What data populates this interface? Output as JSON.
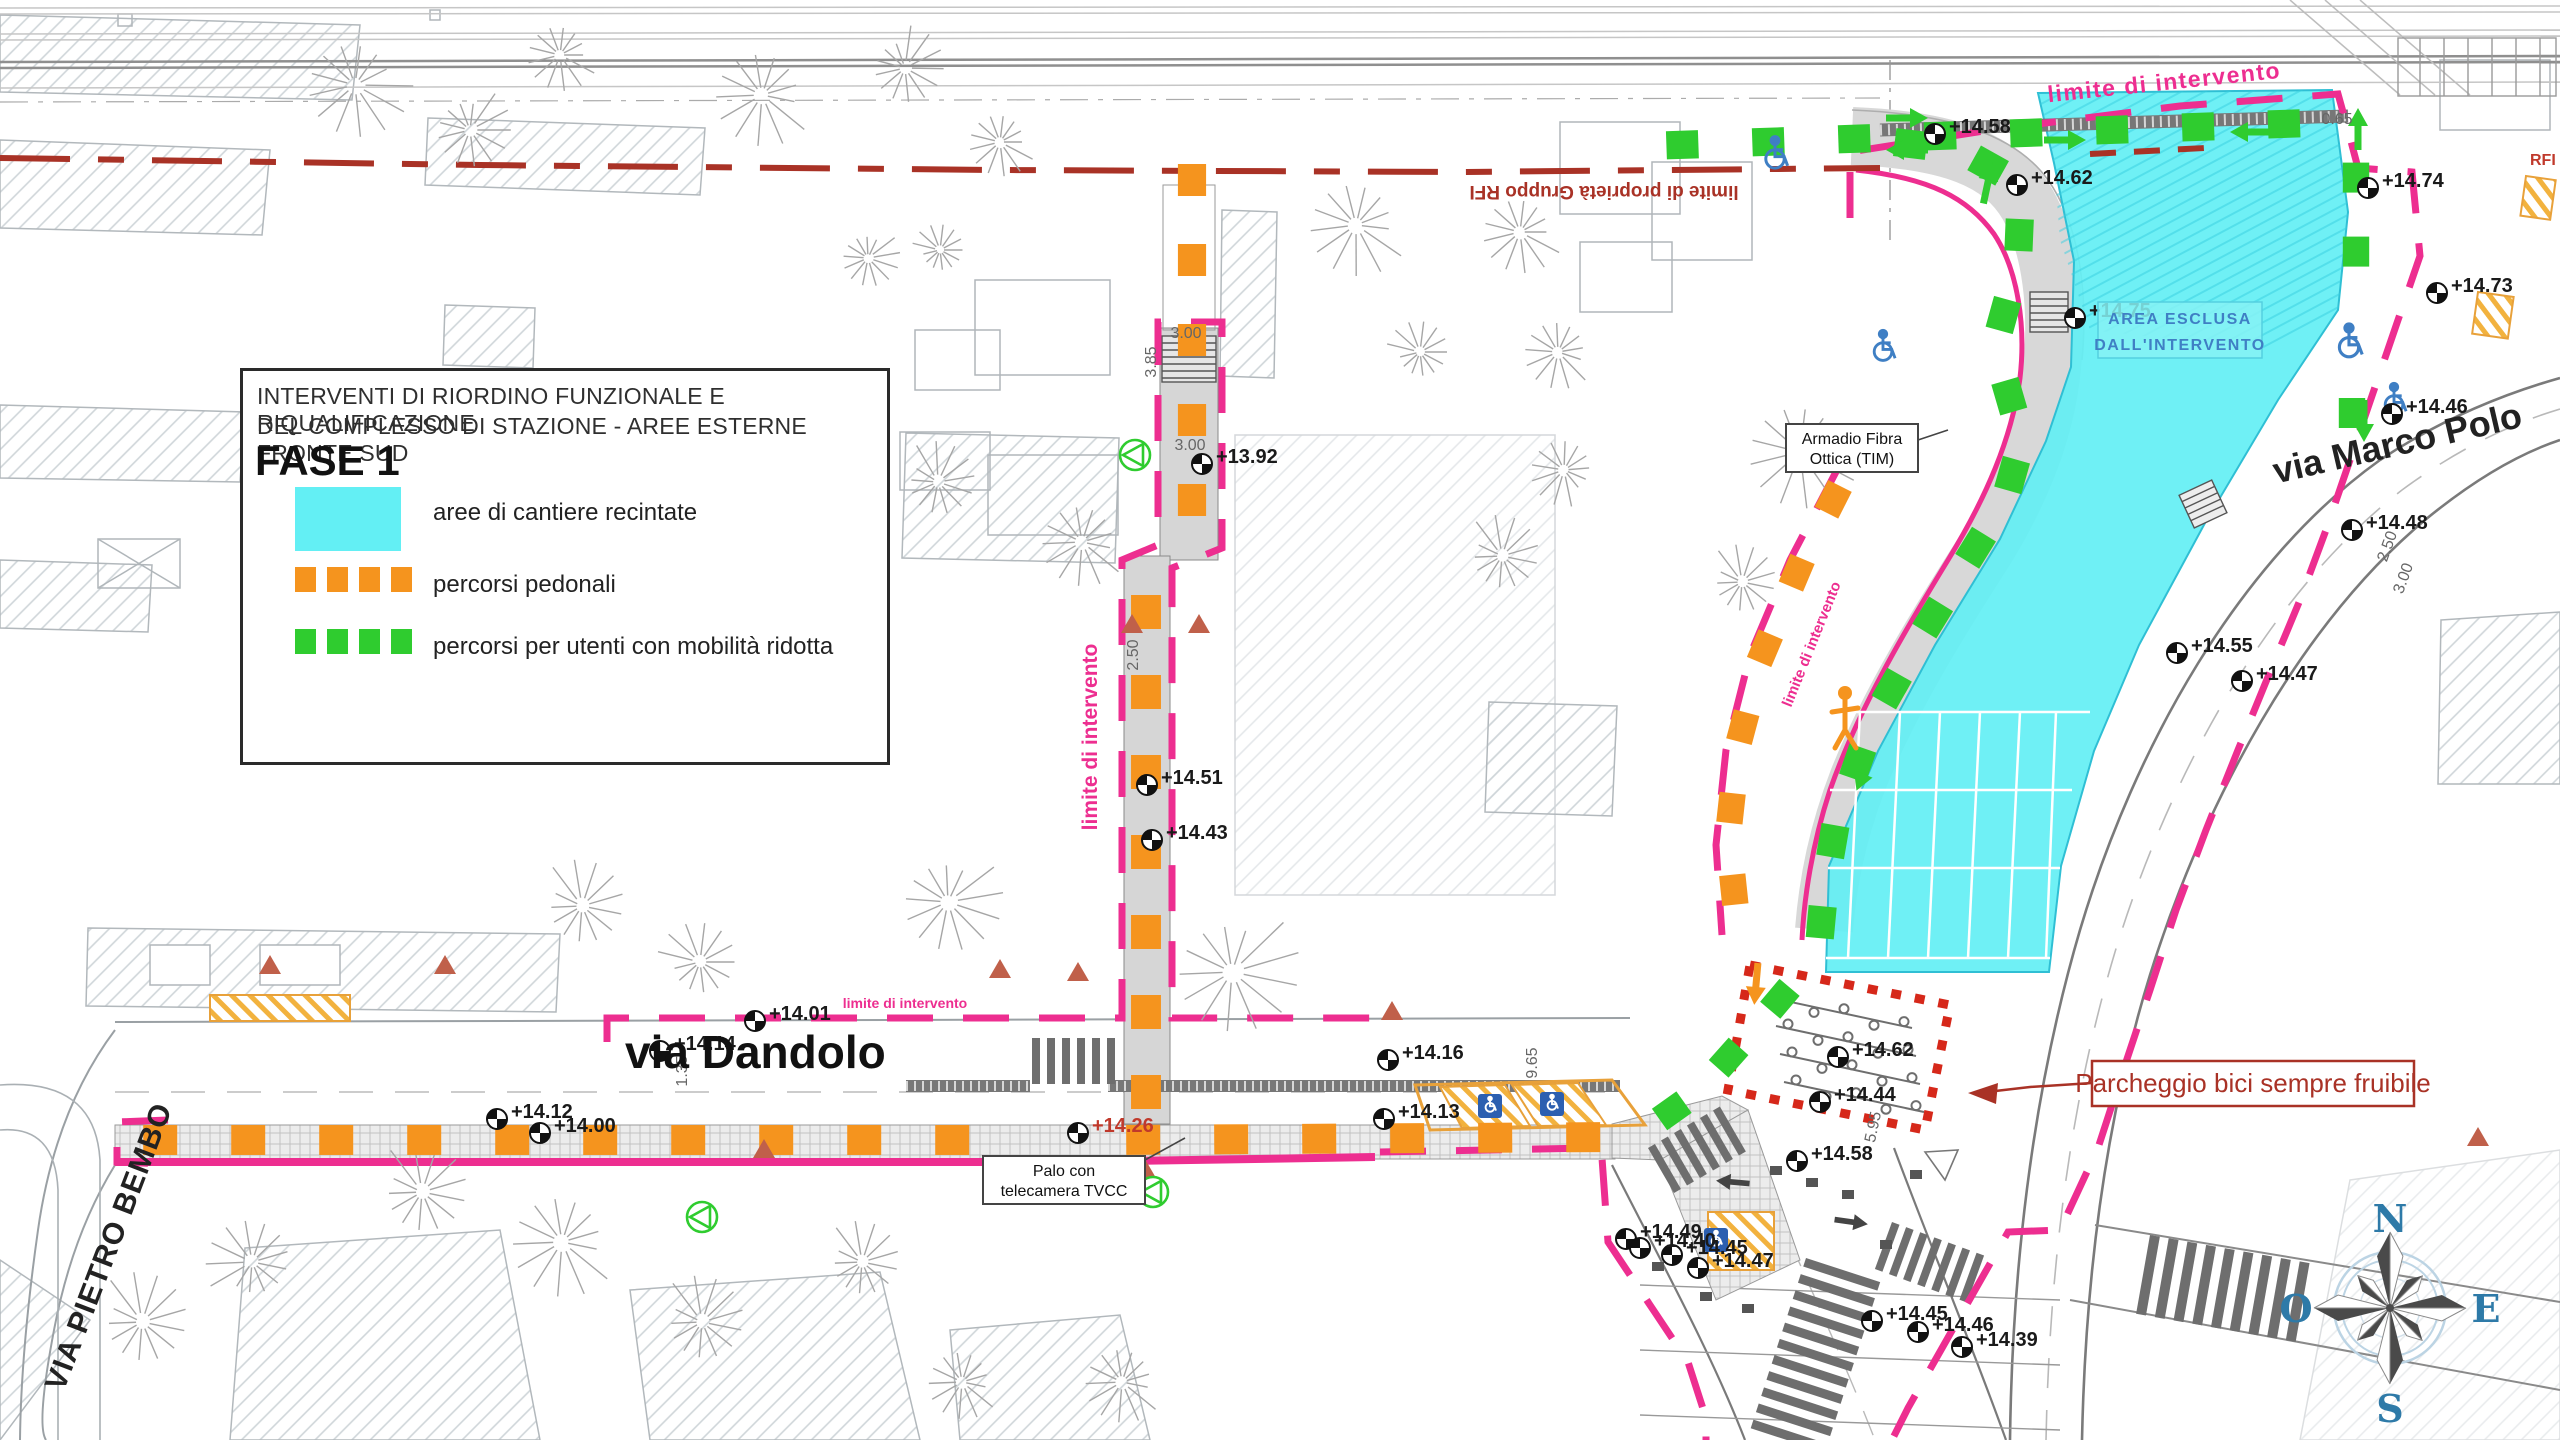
{
  "colors": {
    "cyan": "#63EFF4",
    "cyan_edge": "#2FBFD4",
    "cyan_hatch": "#38CFE0",
    "orange": "#F5941E",
    "green": "#2FCC2F",
    "magenta": "#ED2E90",
    "dark_red": "#A93226",
    "red_dot": "#D6281A",
    "blue": "#3F7FC4",
    "badge_blue": "#2C5FB0",
    "steel": "#2E7AA8",
    "yellow": "#F2B23E",
    "text": "#1A1A1A",
    "dim": "#666666",
    "tree": "#A6A6A6",
    "hatch_line": "#CCD2D6",
    "road": "#7A7A7A",
    "band": "#D8D8D8"
  },
  "legend": {
    "title_line1": "INTERVENTI DI RIORDINO FUNZIONALE E RIQUALIFICAZIONE",
    "title_line2": "DEL COMPLESSO DI STAZIONE - AREE ESTERNE FRONTE SUD",
    "phase": "FASE 1",
    "items": [
      {
        "key": "cyan-area",
        "label": "aree di cantiere recintate"
      },
      {
        "key": "orange-path",
        "label": "percorsi pedonali"
      },
      {
        "key": "green-path",
        "label": "percorsi per utenti con mobilità ridotta"
      }
    ]
  },
  "streets": {
    "dandolo": "via Dandolo",
    "pietro_bembo": "VIA PIETRO BEMBO",
    "marco_polo": "via Marco Polo"
  },
  "boundary_labels": {
    "property": "limite di proprietà Gruppo RFI",
    "intervention": "limite di intervento",
    "rfi": "RFI"
  },
  "callouts": {
    "area_esclusa_1": "AREA ESCLUSA",
    "area_esclusa_2": "DALL'INTERVENTO",
    "armadio_1": "Armadio Fibra",
    "armadio_2": "Ottica (TIM)",
    "palo_1": "Palo con",
    "palo_2": "telecamera TVCC",
    "parcheggio": "Parcheggio bici sempre fruibile"
  },
  "compass": {
    "n": "N",
    "e": "E",
    "s": "S",
    "o": "O"
  },
  "spot_elevations": [
    {
      "x": 2437,
      "y": 293,
      "t": "+14.73"
    },
    {
      "x": 2368,
      "y": 188,
      "t": "+14.74"
    },
    {
      "x": 2352,
      "y": 530,
      "t": "+14.48"
    },
    {
      "x": 2392,
      "y": 414,
      "t": "+14.46"
    },
    {
      "x": 2177,
      "y": 653,
      "t": "+14.55"
    },
    {
      "x": 2242,
      "y": 681,
      "t": "+14.47"
    },
    {
      "x": 2017,
      "y": 185,
      "t": "+14.62"
    },
    {
      "x": 1935,
      "y": 134,
      "t": "+14.58"
    },
    {
      "x": 2075,
      "y": 318,
      "t": "+14.75"
    },
    {
      "x": 1147,
      "y": 785,
      "t": "+14.51"
    },
    {
      "x": 1152,
      "y": 840,
      "t": "+14.43"
    },
    {
      "x": 1202,
      "y": 464,
      "t": "+13.92"
    },
    {
      "x": 755,
      "y": 1021,
      "t": "+14.01"
    },
    {
      "x": 1078,
      "y": 1133,
      "t": "+14.26",
      "red": true
    },
    {
      "x": 1797,
      "y": 1161,
      "t": "+14.58"
    },
    {
      "x": 1672,
      "y": 1255,
      "t": "+14.45"
    },
    {
      "x": 1698,
      "y": 1268,
      "t": "+14.47"
    },
    {
      "x": 1872,
      "y": 1321,
      "t": "+14.45"
    },
    {
      "x": 1918,
      "y": 1332,
      "t": "+14.46"
    },
    {
      "x": 1962,
      "y": 1347,
      "t": "+14.39"
    },
    {
      "x": 1838,
      "y": 1057,
      "t": "+14.62"
    },
    {
      "x": 1820,
      "y": 1102,
      "t": "+14.44"
    },
    {
      "x": 1388,
      "y": 1060,
      "t": "+14.16"
    },
    {
      "x": 1384,
      "y": 1119,
      "t": "+14.13"
    },
    {
      "x": 1626,
      "y": 1239,
      "t": "+14.49"
    },
    {
      "x": 1640,
      "y": 1248,
      "t": "+14.40"
    },
    {
      "x": 660,
      "y": 1051,
      "t": "+14.14"
    },
    {
      "x": 497,
      "y": 1119,
      "t": "+14.12"
    },
    {
      "x": 540,
      "y": 1133,
      "t": "+14.00"
    }
  ],
  "dimensions": [
    {
      "x": 1138,
      "y": 655,
      "t": "2.50",
      "r": -90
    },
    {
      "x": 1186,
      "y": 338,
      "t": "3.00",
      "r": 0
    },
    {
      "x": 1156,
      "y": 362,
      "t": "3.85",
      "r": -90
    },
    {
      "x": 1190,
      "y": 450,
      "t": "3.00",
      "r": 0
    },
    {
      "x": 1537,
      "y": 1063,
      "t": "9.65",
      "r": -90
    },
    {
      "x": 2337,
      "y": 124,
      "t": "0.65",
      "r": 0
    },
    {
      "x": 1878,
      "y": 1128,
      "t": "5.95",
      "r": -78
    },
    {
      "x": 687,
      "y": 1071,
      "t": "1.35",
      "r": -90
    },
    {
      "x": 2392,
      "y": 548,
      "t": "2.50",
      "r": -70
    },
    {
      "x": 2408,
      "y": 580,
      "t": "3.00",
      "r": -70
    }
  ]
}
